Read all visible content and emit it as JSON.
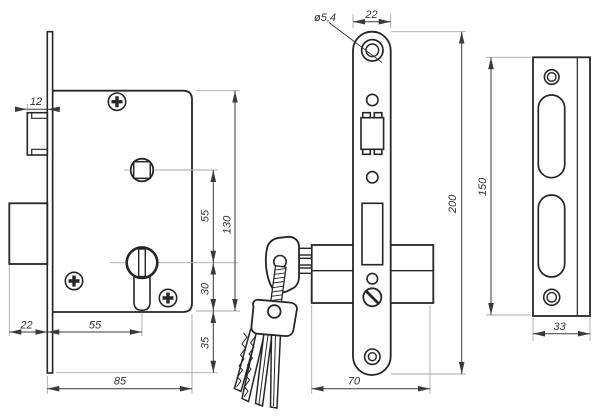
{
  "drawing": {
    "type": "technical-drawing",
    "subject": "mortise-lock-with-cylinder-and-keys",
    "colors": {
      "background": "#ffffff",
      "object_line": "#262626",
      "extension_line": "#a9a9a9",
      "dimension_line": "#3a3a3a",
      "text": "#333333"
    },
    "views": {
      "side": "lock-body-side-view",
      "front": "faceplate-front-view",
      "strike": "strike-plate-view"
    },
    "dims": {
      "latch_protrusion": "12",
      "deadbolt_protrusion": "22",
      "backset": "55",
      "case_depth": "85",
      "spindle_to_cylinder": "55",
      "case_height": "130",
      "cylinder_to_case_bottom": "30",
      "case_bottom_to_plate_end": "35",
      "hole_diameter": "ø5,4",
      "faceplate_width": "22",
      "faceplate_length": "200",
      "body_depth": "70",
      "strike_length": "150",
      "strike_width": "33"
    }
  }
}
